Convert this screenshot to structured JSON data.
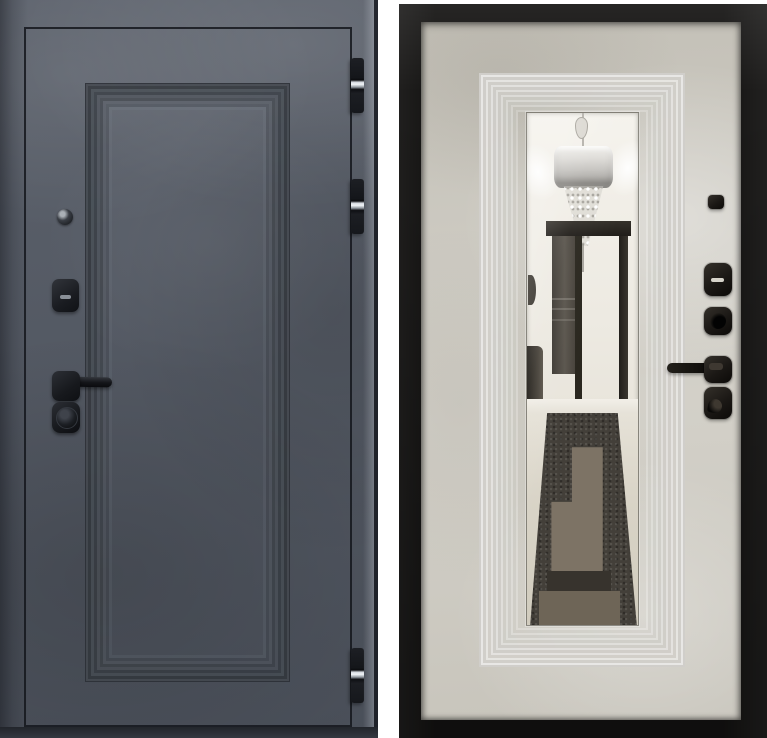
{
  "photo": {
    "subject": "entry-door-shown-from-both-sides",
    "left_panel": {
      "side": "exterior",
      "finish": "dark-concrete",
      "hardware": [
        "peephole",
        "lock-escutcheon",
        "lever-handle",
        "lock-cylinder"
      ],
      "hinge_count": 3
    },
    "right_panel": {
      "side": "interior",
      "finish": "light-concrete",
      "features": [
        "full-height-mirror"
      ],
      "mirror_reflection": [
        "chandelier",
        "hallway-doorway",
        "patterned-rug"
      ],
      "hardware": [
        "latch-knob",
        "lock-escutcheon",
        "lock-cylinder",
        "lever-handle",
        "thumbturn"
      ]
    }
  },
  "colors": {
    "background": "#ffffff",
    "exterior_face": "#525863",
    "exterior_line": "#14161c",
    "hinge_metal": "#d6dbe1",
    "interior_frame": "#141312",
    "interior_panel": "#cdcac1",
    "rug_dark": "#433f39",
    "rug_light": "#7d7365"
  }
}
